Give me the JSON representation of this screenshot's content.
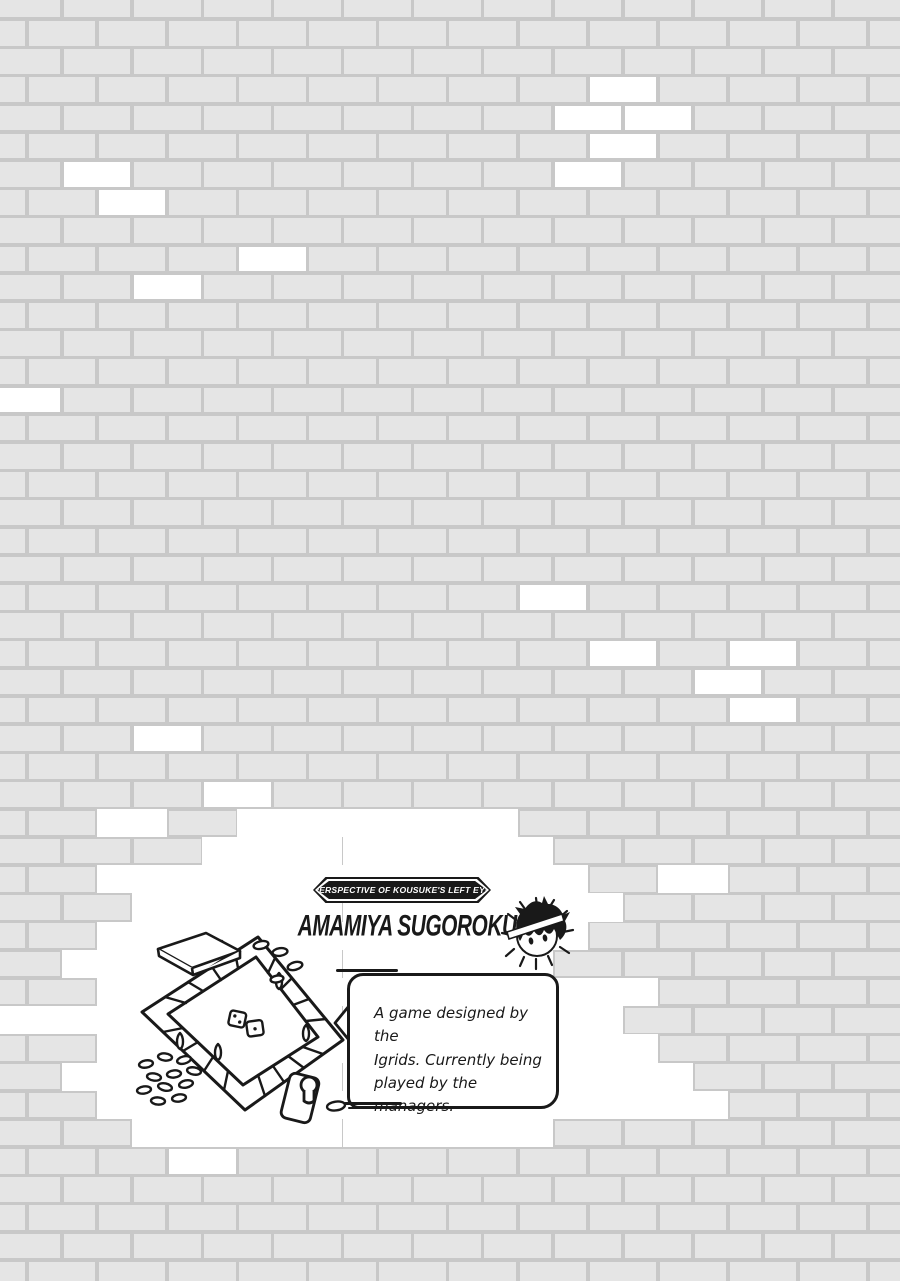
{
  "page": {
    "width": 900,
    "height": 1281,
    "colors": {
      "brick": "#e5e5e5",
      "mortar": "#c8c8c8",
      "white_brick": "#ffffff",
      "ink": "#191919"
    }
  },
  "caption": {
    "banner": "PERSPECTIVE OF KOUSUKE'S LEFT EYE",
    "title": "AMAMIYA SUGOROKU"
  },
  "bubble": {
    "lines": [
      "A game designed by the",
      "Igrids. Currently being",
      "played by the managers."
    ]
  },
  "figures": {
    "face_icon": "kousuke-face-icon",
    "board_sketch": "sugoroku-board-sketch",
    "board_parts": [
      "game-board",
      "dice",
      "pawns",
      "coins",
      "booklet",
      "card"
    ]
  },
  "wall": {
    "rows": 46,
    "white_bricks": [
      {
        "r": 3,
        "cols": [
          8
        ]
      },
      {
        "r": 4,
        "cols": [
          8,
          9
        ]
      },
      {
        "r": 5,
        "cols": [
          8
        ]
      },
      {
        "r": 6,
        "cols": [
          1,
          8
        ]
      },
      {
        "r": 7,
        "cols": [
          1
        ]
      },
      {
        "r": 9,
        "cols": [
          3
        ]
      },
      {
        "r": 10,
        "cols": [
          2
        ]
      },
      {
        "r": 14,
        "cols": [
          0
        ]
      },
      {
        "r": 21,
        "cols": [
          7
        ]
      },
      {
        "r": 23,
        "cols": [
          8,
          10
        ]
      },
      {
        "r": 24,
        "cols": [
          10
        ]
      },
      {
        "r": 25,
        "cols": [
          10
        ]
      },
      {
        "r": 26,
        "cols": [
          2
        ]
      },
      {
        "r": 28,
        "cols": [
          3
        ]
      },
      {
        "r": 29,
        "cols": [
          1,
          3,
          4,
          5,
          6
        ],
        "blob": true
      },
      {
        "r": 30,
        "cols": [
          3,
          4,
          5,
          6,
          7
        ],
        "blob": true
      },
      {
        "r": 31,
        "cols": [
          1,
          2,
          3,
          4,
          5,
          6,
          7,
          9
        ],
        "blob": true
      },
      {
        "r": 32,
        "cols": [
          2,
          3,
          4,
          5,
          6,
          7,
          8
        ],
        "blob": true
      },
      {
        "r": 33,
        "cols": [
          1,
          2,
          3,
          4,
          5,
          6,
          7
        ],
        "blob": true
      },
      {
        "r": 34,
        "cols": [
          1,
          2,
          3,
          4,
          5,
          6,
          7
        ],
        "blob": true
      },
      {
        "r": 35,
        "cols": [
          1,
          2,
          3,
          4,
          5,
          6,
          7,
          8
        ],
        "blob": true
      },
      {
        "r": 36,
        "cols": [
          0,
          1,
          2,
          3,
          4,
          5,
          6,
          7,
          8
        ],
        "blob": true
      },
      {
        "r": 37,
        "cols": [
          1,
          2,
          3,
          4,
          5,
          6,
          7,
          8
        ],
        "blob": true
      },
      {
        "r": 38,
        "cols": [
          1,
          2,
          3,
          4,
          5,
          6,
          7,
          8,
          9
        ],
        "blob": true
      },
      {
        "r": 39,
        "cols": [
          1,
          2,
          3,
          4,
          5,
          6,
          7,
          8,
          9
        ],
        "blob": true
      },
      {
        "r": 40,
        "cols": [
          2,
          3,
          4,
          5,
          6,
          7
        ],
        "blob": true
      },
      {
        "r": 41,
        "cols": [
          2
        ]
      }
    ]
  }
}
